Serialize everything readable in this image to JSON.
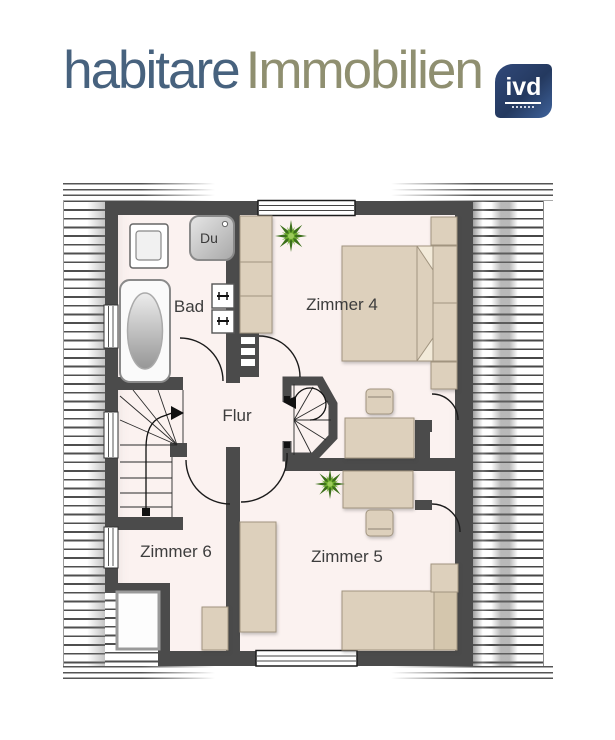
{
  "header": {
    "brand_primary": "habitare",
    "brand_secondary": "Immobilien",
    "logo_text": "ivd"
  },
  "floorplan": {
    "rooms": [
      {
        "id": "bad",
        "label": "Bad"
      },
      {
        "id": "flur",
        "label": "Flur"
      },
      {
        "id": "zimmer4",
        "label": "Zimmer 4"
      },
      {
        "id": "zimmer5",
        "label": "Zimmer 5"
      },
      {
        "id": "zimmer6",
        "label": "Zimmer 6"
      }
    ],
    "fixtures": {
      "shower_label": "Du"
    }
  },
  "colors": {
    "wall": "#4b4b4b",
    "floor": "#fbf2f0",
    "furniture": "#ddd0bc",
    "brand_primary": "#47627e",
    "brand_secondary": "#8f8f70",
    "logo_bg": "#24395f",
    "plant_green": "#4e8a1e"
  }
}
